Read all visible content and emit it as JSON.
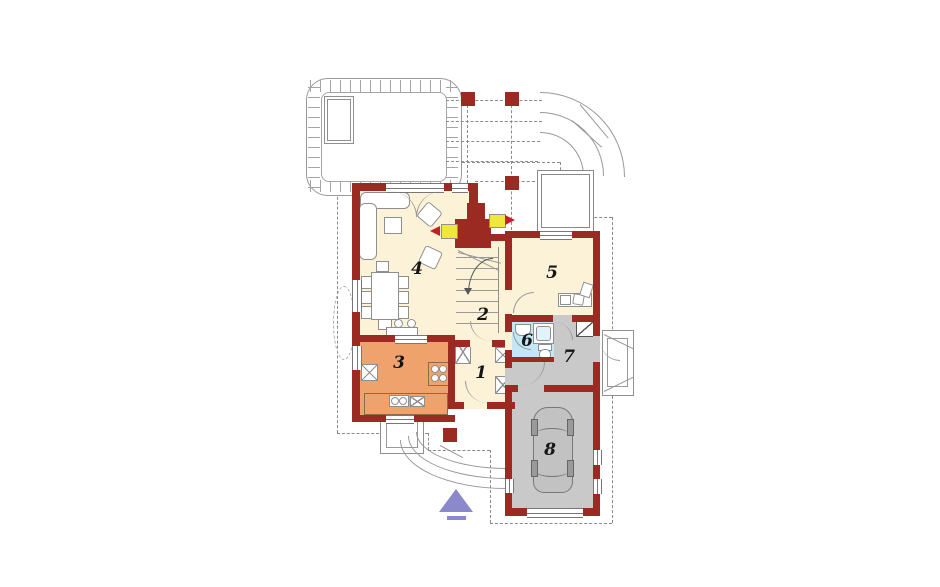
{
  "palette": {
    "wall": "#9b2a23",
    "floor_cream": "#fbf2d7",
    "floor_orange": "#efa26c",
    "floor_blue": "#c4e7f6",
    "floor_gray": "#c9c9c9",
    "entrance_arrow": "#8b88cb",
    "fire_yellow": "#f1e63a",
    "fire_red": "#c32222",
    "line_gray": "#8f8f8f"
  },
  "rooms": {
    "r1": {
      "label": "1"
    },
    "r2": {
      "label": "2"
    },
    "r3": {
      "label": "3"
    },
    "r4": {
      "label": "4"
    },
    "r5": {
      "label": "5"
    },
    "r6": {
      "label": "6"
    },
    "r7": {
      "label": "7"
    },
    "r8": {
      "label": "8"
    }
  }
}
